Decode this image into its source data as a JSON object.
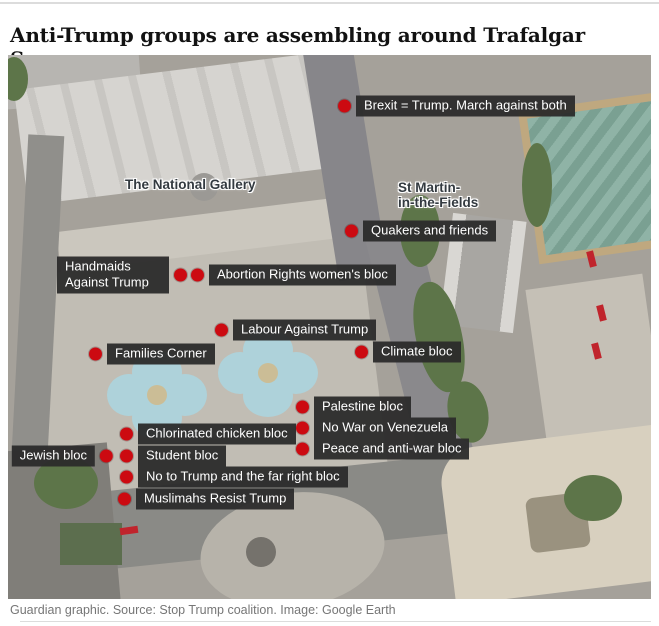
{
  "header": {
    "title": "Anti-Trump groups are assembling around Trafalgar Square"
  },
  "footer": {
    "caption": "Guardian graphic. Source: Stop Trump coalition. Image: Google Earth"
  },
  "colors": {
    "marker_dot_red": "#cc0a11",
    "label_background": "#333333",
    "label_text": "#ffffff",
    "headline_text": "#121212",
    "caption_text": "#767676",
    "fountain_water": "#aed2da",
    "tree_green": "#5d7549",
    "pavement": "#c1bdb4"
  },
  "map": {
    "place_labels": [
      {
        "name": "the-national-gallery",
        "label": "The National Gallery"
      },
      {
        "name": "st-martin-in-the-fields",
        "label": "St Martin-\nin-the-Fields"
      }
    ],
    "markers": [
      {
        "label": "Brexit = Trump. March against both",
        "side": "right"
      },
      {
        "label": "Quakers and friends",
        "side": "right"
      },
      {
        "label": "Handmaids Against Trump",
        "side": "left"
      },
      {
        "label": "Abortion Rights women's bloc",
        "side": "right"
      },
      {
        "label": "Labour Against Trump",
        "side": "right"
      },
      {
        "label": "Climate bloc",
        "side": "right"
      },
      {
        "label": "Families Corner",
        "side": "right"
      },
      {
        "label": "Palestine bloc",
        "side": "right"
      },
      {
        "label": "No War on Venezuela",
        "side": "right"
      },
      {
        "label": "Peace and anti-war bloc",
        "side": "right"
      },
      {
        "label": "Chlorinated chicken bloc",
        "side": "right"
      },
      {
        "label": "Jewish bloc",
        "side": "left"
      },
      {
        "label": "Student bloc",
        "side": "right"
      },
      {
        "label": "No to Trump and the far right bloc",
        "side": "right"
      },
      {
        "label": "Muslimahs Resist Trump",
        "side": "right"
      }
    ]
  }
}
